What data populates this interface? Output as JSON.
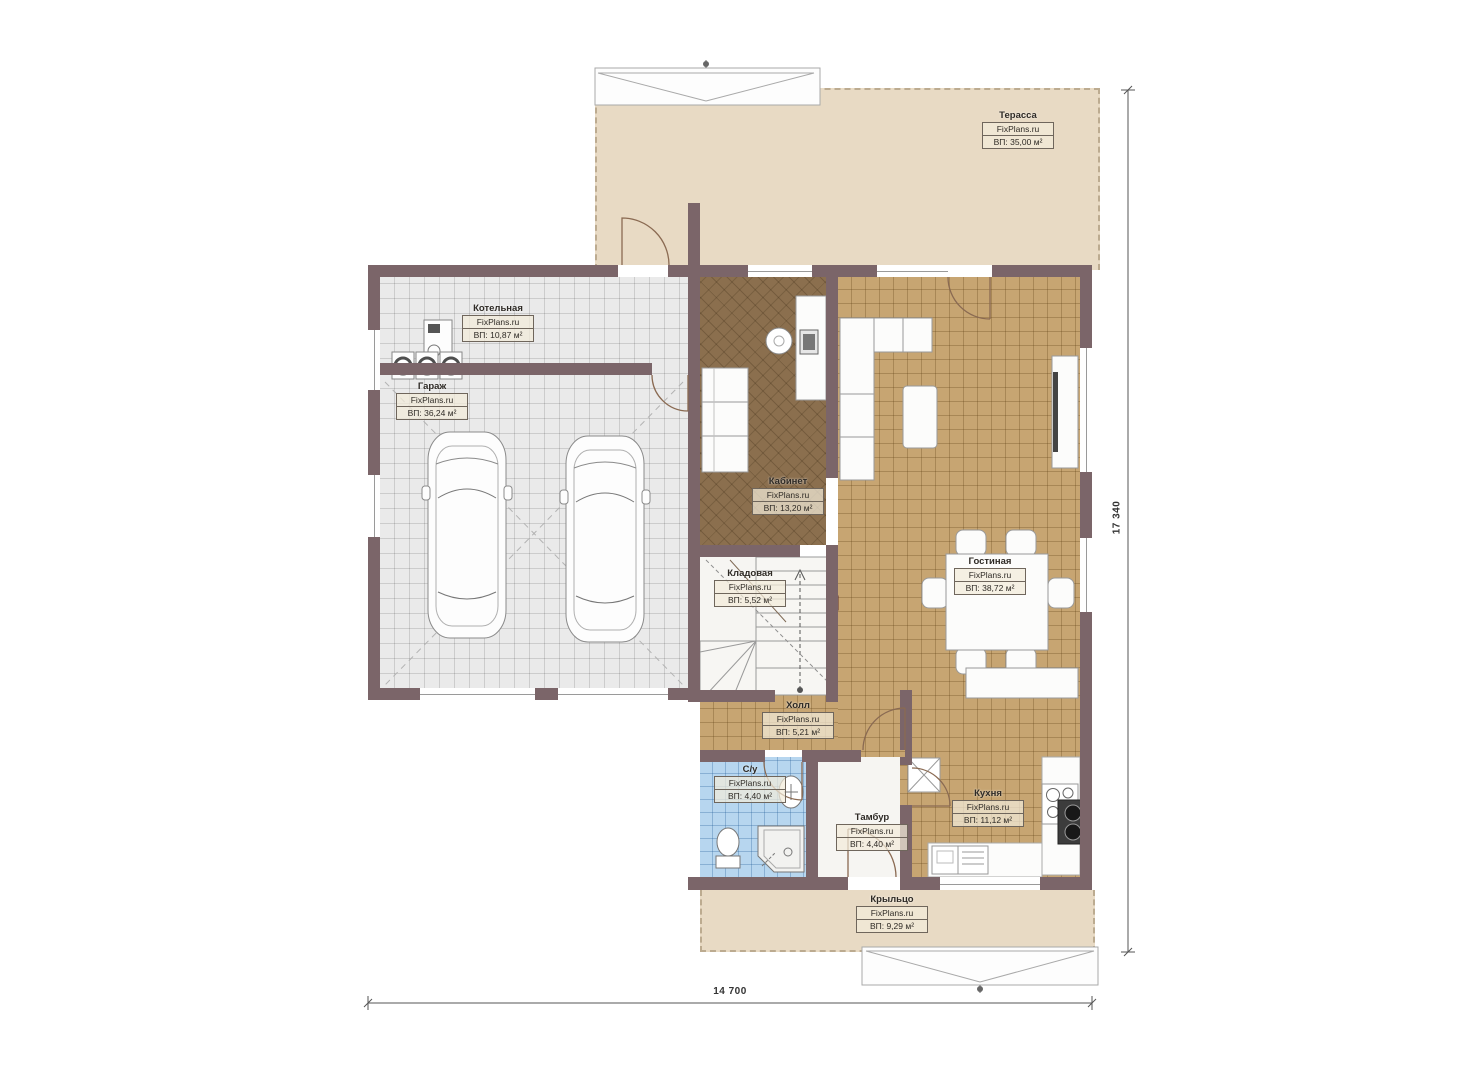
{
  "plan": {
    "title": "Поэтажный план — 1 этаж",
    "brand": "FixPlans.ru",
    "rooms": [
      {
        "id": "terrace",
        "name": "Терасса",
        "brand": "FixPlans.ru",
        "area": "ВП: 35,00 м²"
      },
      {
        "id": "boiler",
        "name": "Котельная",
        "brand": "FixPlans.ru",
        "area": "ВП: 10,87 м²"
      },
      {
        "id": "garage",
        "name": "Гараж",
        "brand": "FixPlans.ru",
        "area": "ВП: 36,24 м²"
      },
      {
        "id": "office",
        "name": "Кабинет",
        "brand": "FixPlans.ru",
        "area": "ВП: 13,20 м²"
      },
      {
        "id": "storage",
        "name": "Кладовая",
        "brand": "FixPlans.ru",
        "area": "ВП: 5,52 м²"
      },
      {
        "id": "living",
        "name": "Гостиная",
        "brand": "FixPlans.ru",
        "area": "ВП: 38,72 м²"
      },
      {
        "id": "hall",
        "name": "Холл",
        "brand": "FixPlans.ru",
        "area": "ВП: 5,21 м²"
      },
      {
        "id": "wc",
        "name": "С/у",
        "brand": "FixPlans.ru",
        "area": "ВП: 4,40 м²"
      },
      {
        "id": "vestibule",
        "name": "Тамбур",
        "brand": "FixPlans.ru",
        "area": "ВП: 4,40 м²"
      },
      {
        "id": "kitchen",
        "name": "Кухня",
        "brand": "FixPlans.ru",
        "area": "ВП: 11,12 м²"
      },
      {
        "id": "porch",
        "name": "Крыльцо",
        "brand": "FixPlans.ru",
        "area": "ВП: 9,29 м²"
      }
    ],
    "dimensions": {
      "width": "14 700",
      "height": "17 340"
    },
    "colors": {
      "wall": "#7b6569",
      "terrace_floor": "#e8dac4",
      "living_floor": "#c7a572",
      "office_floor": "#8b6f4e",
      "garage_floor": "#eaeaea",
      "bath_floor": "#b7d6ef"
    }
  }
}
